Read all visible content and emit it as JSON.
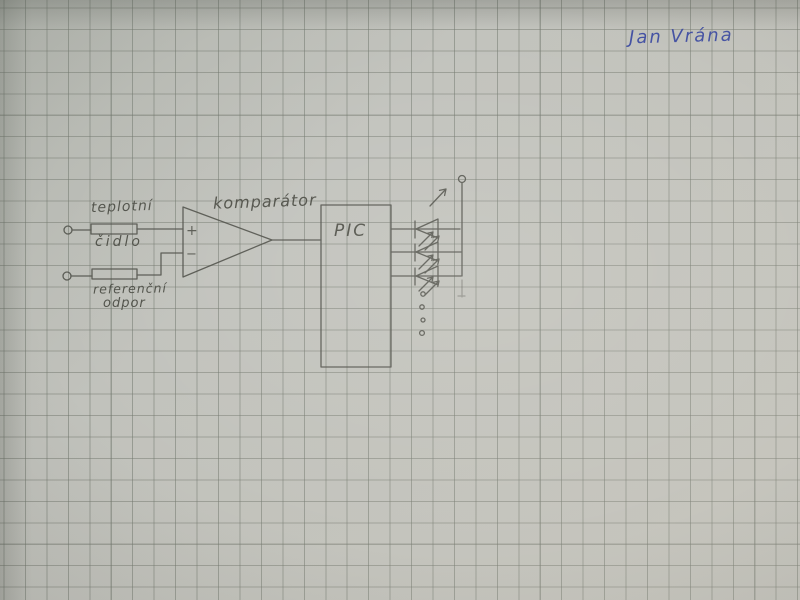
{
  "photo": {
    "kind": "hand-drawn circuit schematic on squared graph paper",
    "paper_color": "#c1c2bc",
    "grid_color": "#6e746a",
    "pencil_color": "#4d4e47",
    "ink_color": "#3646a0"
  },
  "signature": {
    "text": "Jan Vrána"
  },
  "schematic": {
    "labels": {
      "sensor_top": "teplotní",
      "sensor_bottom": "čidlo",
      "reference_top": "referenční",
      "reference_bottom": "odpor",
      "comparator": "komparátor",
      "mcu": "PIC",
      "plus": "+",
      "minus": "−"
    },
    "counts": {
      "input_terminals": 2,
      "resistors": 2,
      "leds": 3,
      "continuation_dots": 4
    }
  }
}
